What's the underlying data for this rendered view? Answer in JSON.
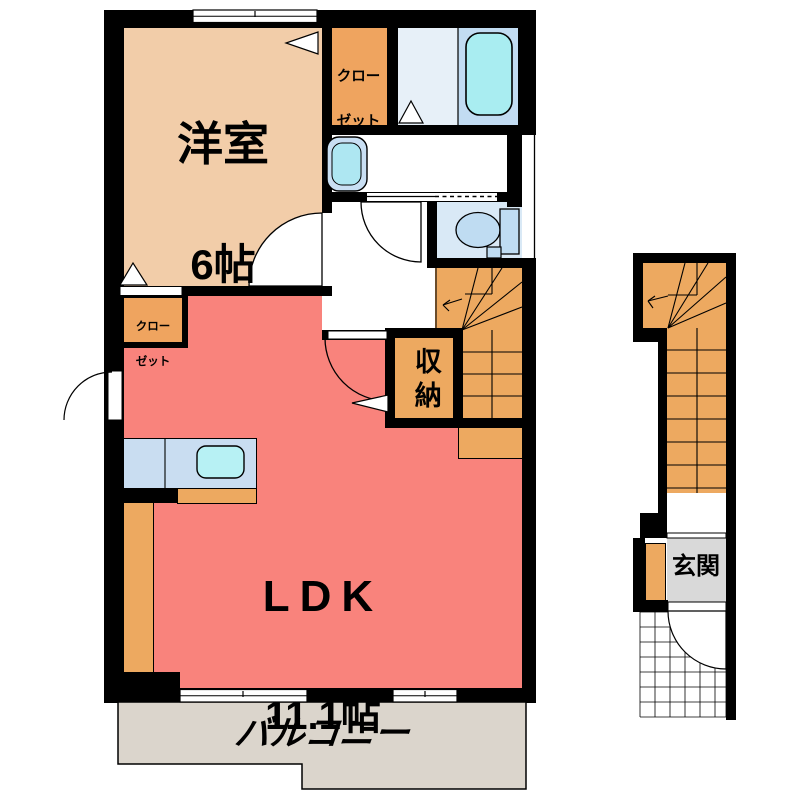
{
  "plan": {
    "type": "apartment-floor-plan",
    "rooms": {
      "western": {
        "name": "洋室",
        "size": "6帖",
        "color": "#F2CDA9"
      },
      "ldk": {
        "name": "LDK",
        "size": "11.1帖",
        "color": "#F9837C"
      },
      "closet_top": {
        "line1": "クロー",
        "line2": "ゼット",
        "color": "#EFA45F"
      },
      "closet_ldk": {
        "line1": "クロー",
        "line2": "ゼット",
        "color": "#EFA45F"
      },
      "storage": {
        "label": "収納",
        "color": "#EDA960"
      },
      "balcony": {
        "label": "バルコニー",
        "color": "#DBD5CC"
      },
      "entrance": {
        "label": "玄関",
        "floor_color": "#D9D9D9"
      }
    },
    "fixtures": [
      "bathtub",
      "washbasin",
      "toilet",
      "kitchen-sink",
      "kitchen-counter",
      "staircase-main",
      "staircase-entrance",
      "shoe-cabinet",
      "porch-tile-grid"
    ],
    "openings": {
      "windows": 3,
      "hinged-doors": 5,
      "sliding-doors": 1
    },
    "colors": {
      "wall": "#000000",
      "stairs": "#EDA960",
      "bathroom_floor": "#C2DCF2",
      "bathtub": "#A9EDF1",
      "toilet_floor": "#D9E9F6",
      "toilet_fixture": "#BFDCF2",
      "counter": "#C9DDF1",
      "sink": "#B7F1F4",
      "balcony": "#DBD5CC"
    }
  }
}
